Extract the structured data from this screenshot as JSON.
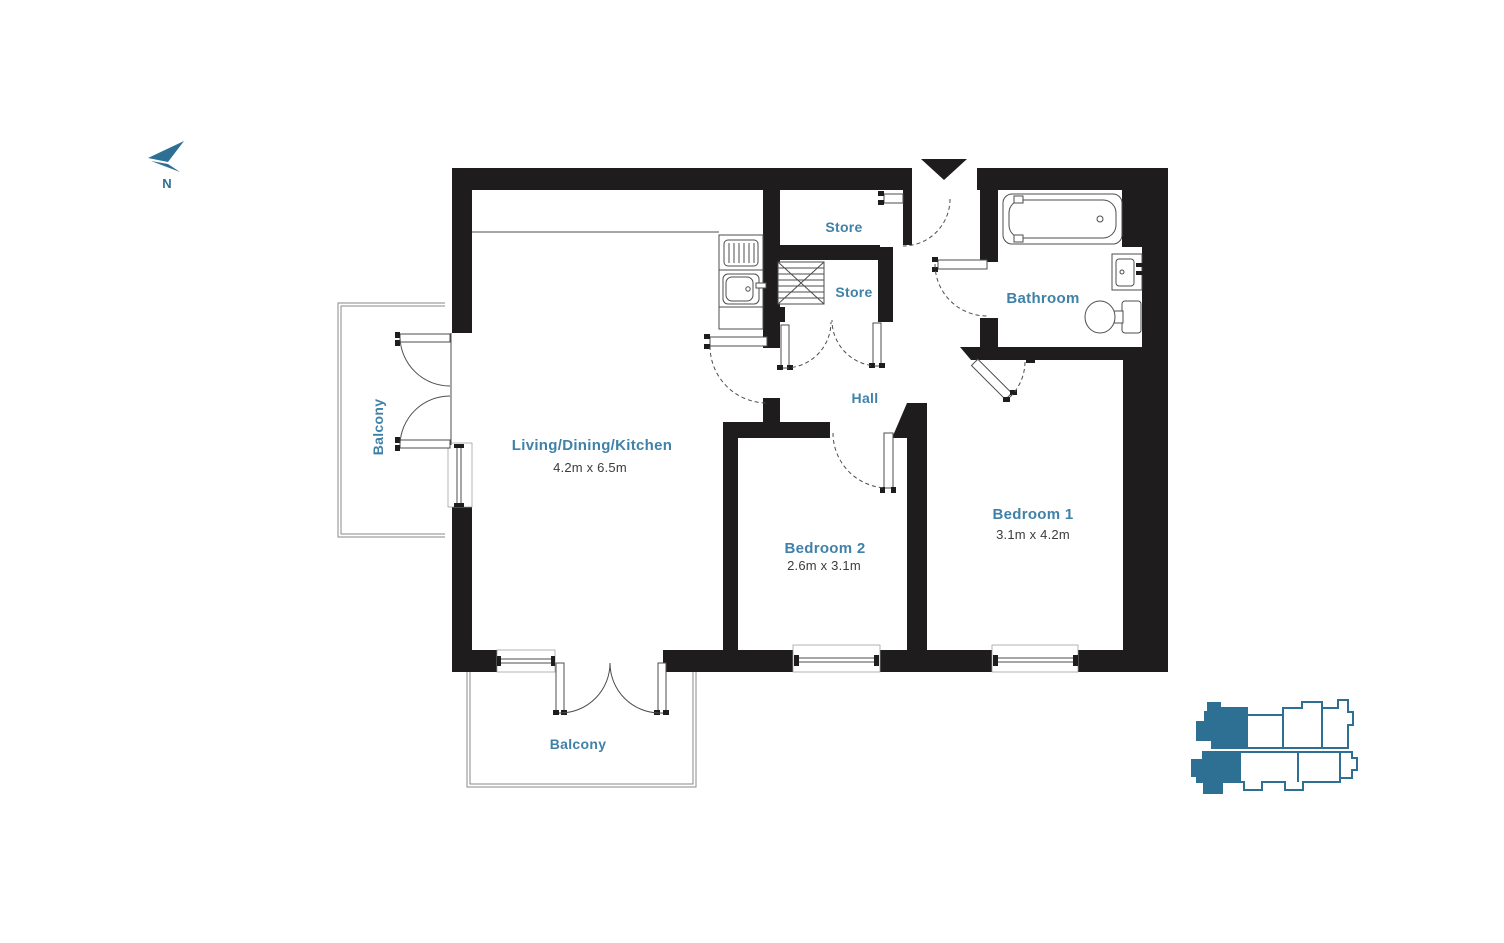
{
  "compass": {
    "north": "N"
  },
  "rooms": {
    "living": {
      "label": "Living/Dining/Kitchen",
      "dims": "4.2m x 6.5m"
    },
    "bedroom1": {
      "label": "Bedroom 1",
      "dims": "3.1m x 4.2m"
    },
    "bedroom2": {
      "label": "Bedroom 2",
      "dims": "2.6m x 3.1m"
    },
    "bathroom": {
      "label": "Bathroom"
    },
    "hall": {
      "label": "Hall"
    },
    "store_top": {
      "label": "Store"
    },
    "store_inner": {
      "label": "Store"
    },
    "balcony_side": {
      "label": "Balcony"
    },
    "balcony_front": {
      "label": "Balcony"
    }
  },
  "colors": {
    "wall": "#1e1c1c",
    "label_teal": "#3f81a8",
    "dims_gray": "#3c3c3c",
    "locator_teal": "#2e6f94"
  }
}
